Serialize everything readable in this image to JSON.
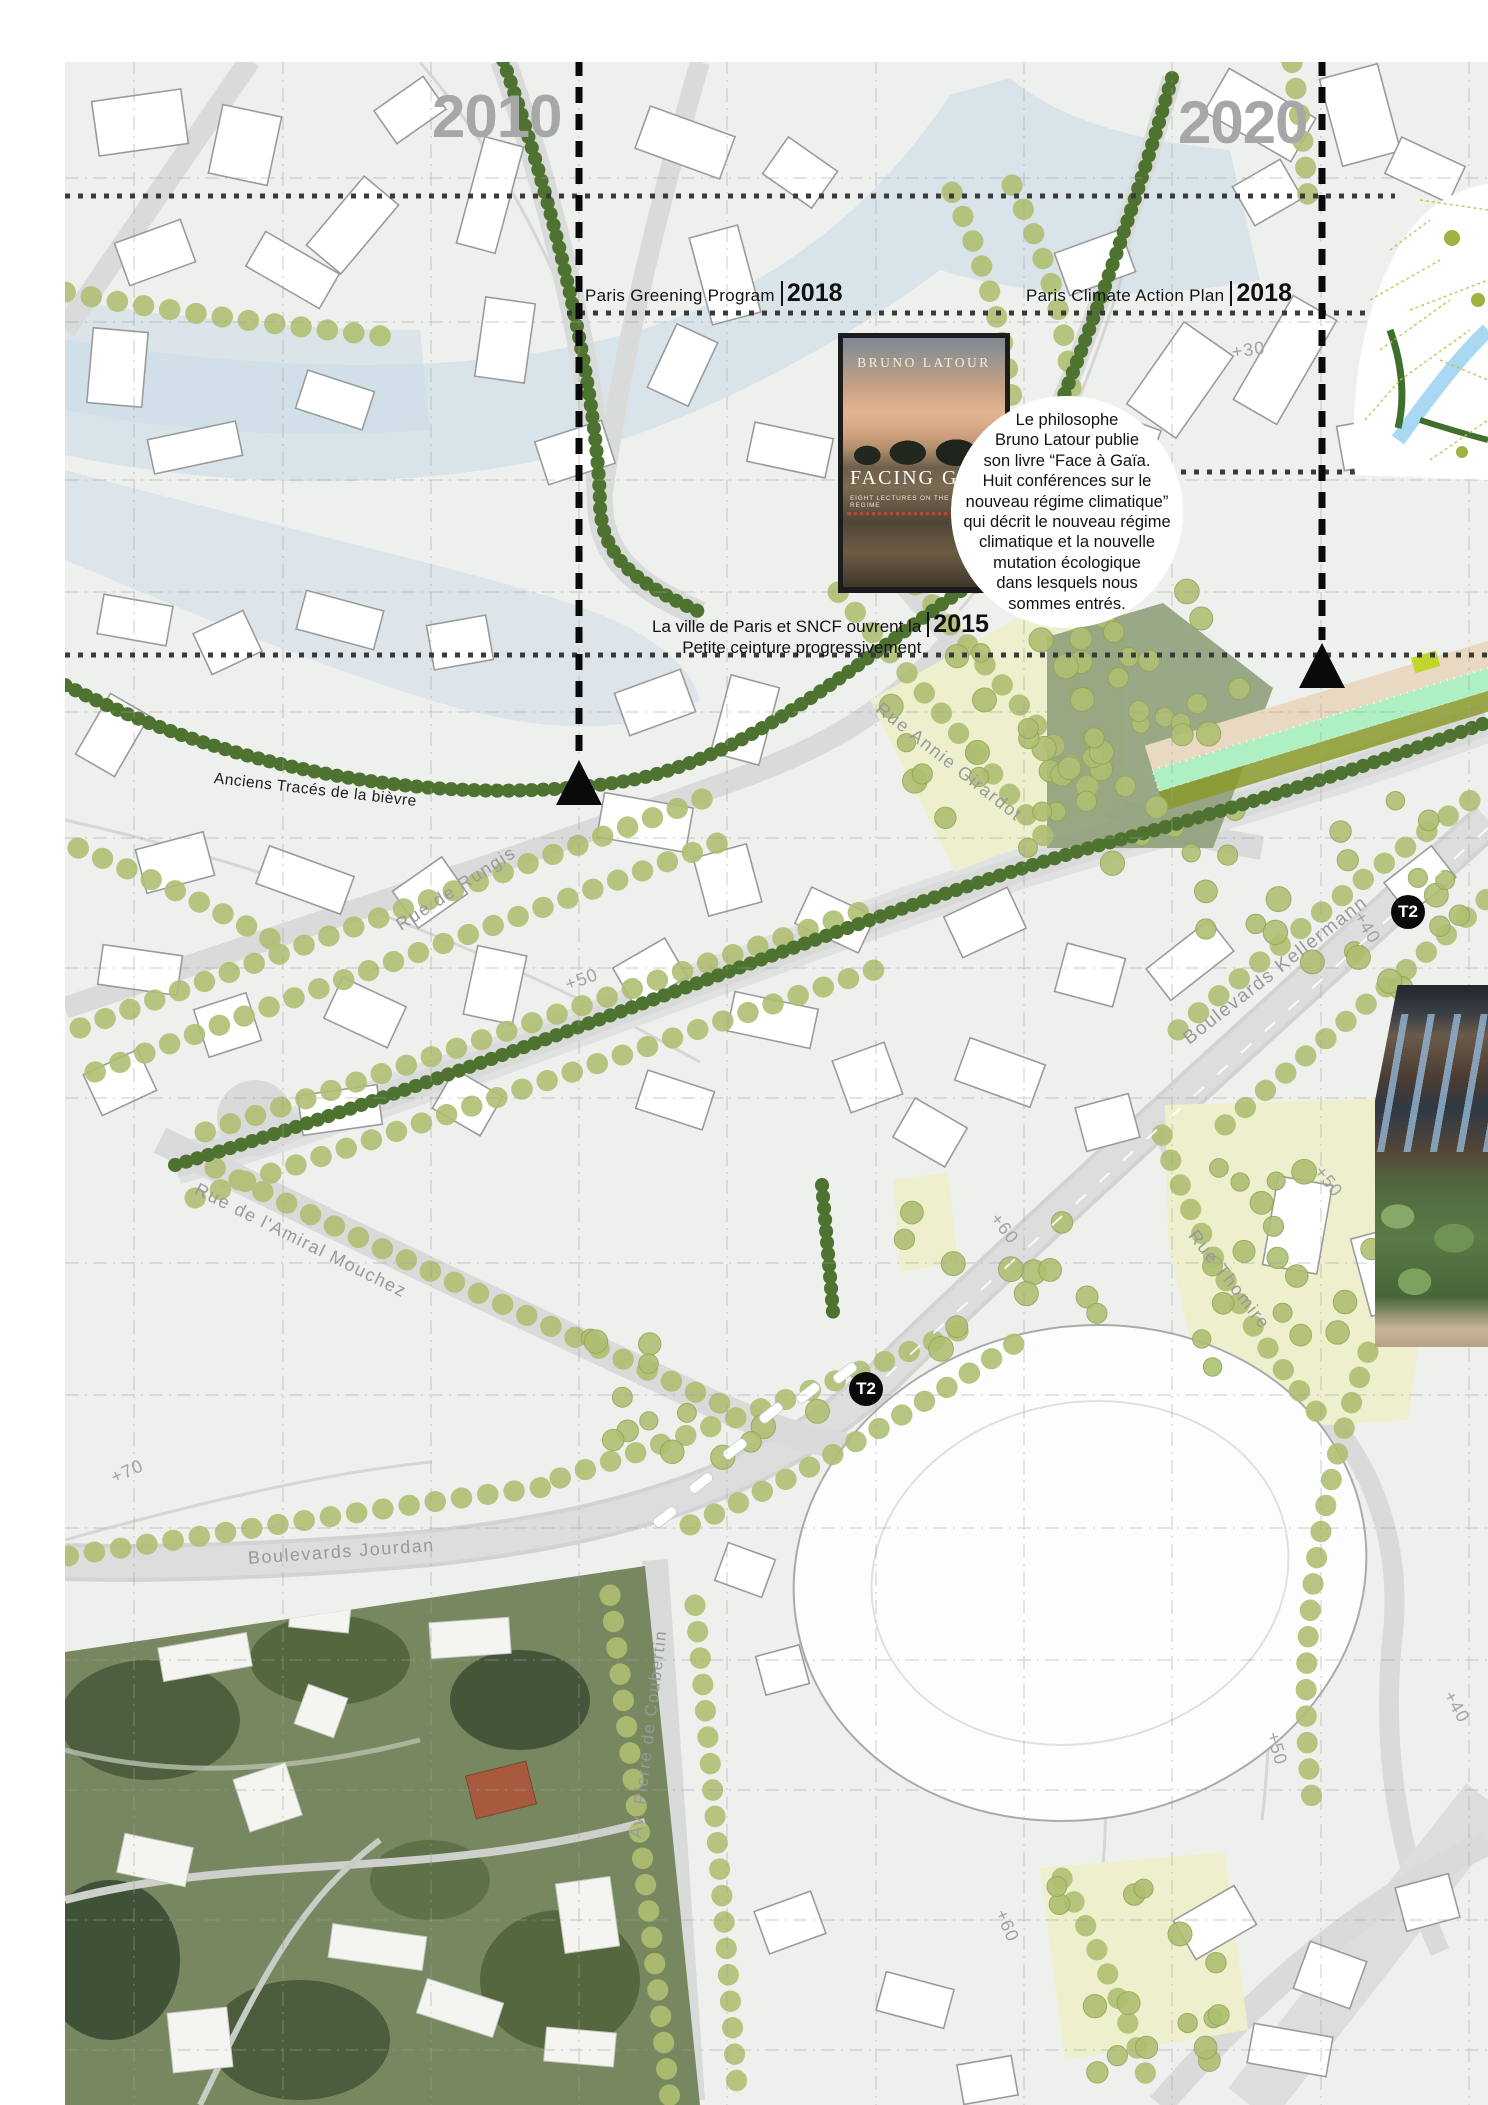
{
  "timeline": {
    "years": {
      "left": "2010",
      "right": "2020"
    },
    "events": [
      {
        "label": "Paris Greening Program",
        "year": "2018"
      },
      {
        "label": "Paris Climate Action Plan",
        "year": "2018"
      },
      {
        "line1": "La ville de Paris et SNCF ouvrent la",
        "line2": "Petite ceinture progressivement",
        "year": "2015"
      }
    ]
  },
  "book": {
    "author": "BRUNO LATOUR",
    "title": "FACING GAIA",
    "subtitle": "EIGHT LECTURES ON THE NEW CLIMATIC REGIME"
  },
  "bubble": {
    "lines": [
      "Le philosophe",
      "Bruno Latour publie",
      "son livre “Face à Gaïa.",
      "Huit conférences sur le",
      "nouveau régime climatique”",
      "qui décrit le nouveau régime",
      "climatique et la nouvelle",
      "mutation écologique",
      "dans lesquels nous",
      "sommes entrés."
    ]
  },
  "map_labels": {
    "historic": "Anciens Tracés de la bièvre",
    "tram": "T2",
    "streets": [
      "Rue de Rungis",
      "Rue Annie Girardot",
      "Boulevards Kellermann",
      "Rue de l'Amiral Mouchez",
      "Rue Thomire",
      "Boulevards Jourdan",
      "Av. Pierre de Coubertin"
    ],
    "elevations": [
      "+30",
      "+40",
      "+50",
      "+60",
      "+70",
      "+50",
      "+40",
      "+50",
      "+60"
    ]
  },
  "colors": {
    "chain_green": "#4e7230",
    "tree_olive": "#afbf72",
    "blue_wash": "#bcd3e6",
    "sage_park": "#8d9d77",
    "pale_field": "#edefcd",
    "road_gray": "#d9dbda",
    "map_bg": "#eef0ee",
    "label_gray": "#97999a"
  }
}
